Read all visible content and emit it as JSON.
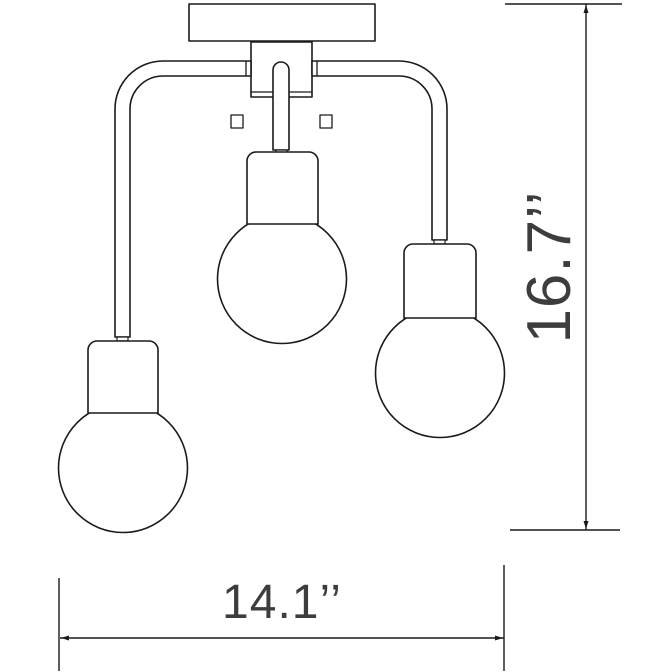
{
  "page": {
    "background_color": "#ffffff"
  },
  "drawing": {
    "type": "technical-dimension-drawing",
    "subject": "3-light semi-flush ceiling fixture",
    "line_color": "#1a1a1a",
    "text_color": "#3d3d3d",
    "fill_color": "#ffffff"
  },
  "dimensions": {
    "height": {
      "label": "16.7’’",
      "value": 16.7,
      "unit": "inches",
      "orientation": "vertical"
    },
    "width": {
      "label": "14.1’’",
      "value": 14.1,
      "unit": "inches",
      "orientation": "horizontal"
    }
  }
}
